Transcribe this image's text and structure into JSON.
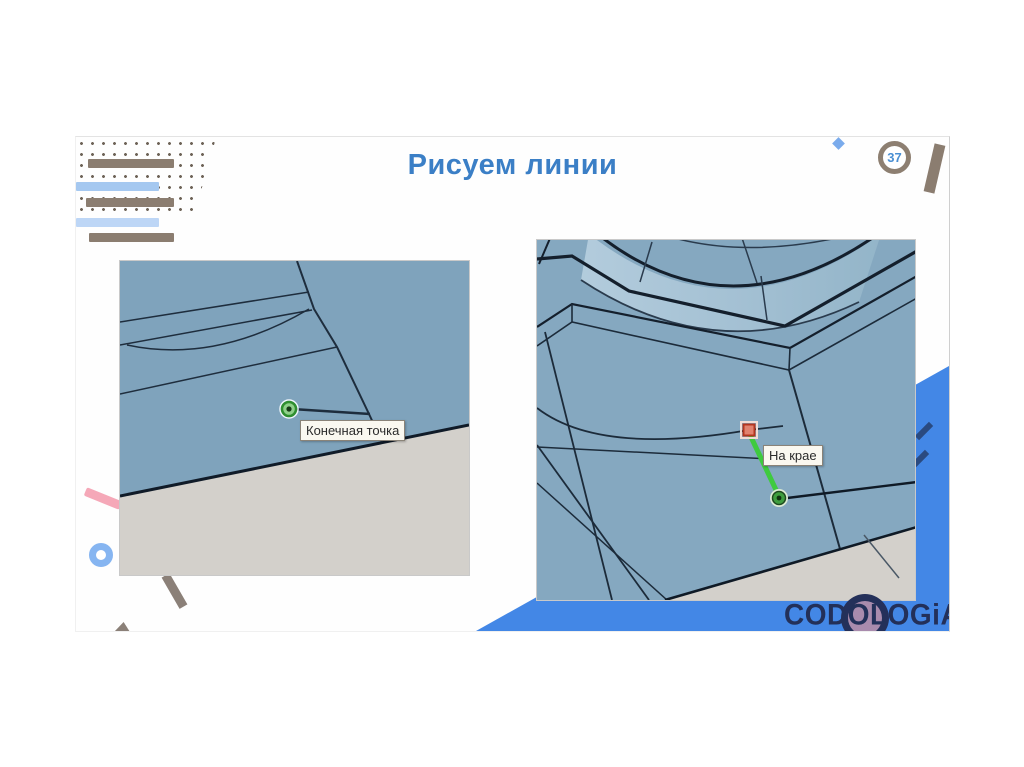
{
  "slide": {
    "title": "Рисуем линии",
    "number": "37"
  },
  "left_screenshot": {
    "tooltip": "Конечная точка"
  },
  "right_screenshot": {
    "tooltip": "На крае"
  },
  "logo": {
    "text": "CODOLOGiA"
  },
  "colors": {
    "title_blue": "#3b7fc6",
    "badge_ring_taupe": "#8d7f71",
    "badge_number_blue": "#4a8fd3",
    "accent_blue_shape": "#4387e6",
    "decor_taupe": "#8b7d70",
    "decor_light_blue": "#a5c8f0",
    "decor_pale_blue": "#bdd6f6",
    "decor_pink": "#f5a8b8",
    "surface_blue": "#7fa3bc",
    "ground_gray": "#d3d0cb",
    "edge_navy": "#1e2d3d",
    "marker_green": "#2f9e2f",
    "inference_line_green": "#3fca3f",
    "marker_red_fill": "#e2826f",
    "marker_red_border": "#b5361f",
    "tooltip_bg": "#faf8f0",
    "logo_navy": "#233059"
  }
}
